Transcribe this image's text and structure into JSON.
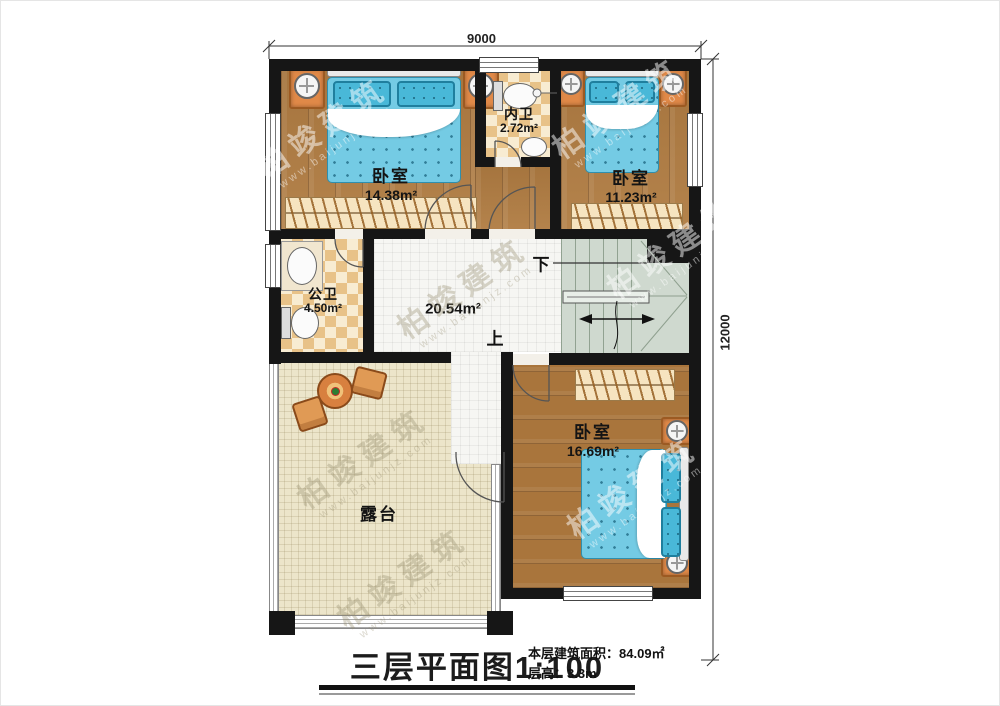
{
  "title": {
    "text": "三层平面图1:100"
  },
  "info": {
    "area_label": "本层建筑面积：",
    "area_value": "84.09㎡",
    "height_label": "层高：",
    "height_value": "3.3m"
  },
  "dimensions": {
    "top": "9000",
    "right": "12000"
  },
  "stairs": {
    "up": "上",
    "down": "下"
  },
  "rooms": [
    {
      "id": "bedroom-1",
      "name": "卧室",
      "area": "14.38m²"
    },
    {
      "id": "bath-inner",
      "name": "内卫",
      "area": "2.72m²"
    },
    {
      "id": "bedroom-2",
      "name": "卧室",
      "area": "11.23m²"
    },
    {
      "id": "bath-public",
      "name": "公卫",
      "area": "4.50m²"
    },
    {
      "id": "hall",
      "name": "",
      "area": "20.54m²"
    },
    {
      "id": "bedroom-3",
      "name": "卧室",
      "area": "16.69m²"
    },
    {
      "id": "terrace",
      "name": "露台",
      "area": ""
    }
  ],
  "watermark": {
    "brand": "柏竣建筑",
    "url": "www.baijunjz.com"
  },
  "colors": {
    "wall": "#161616",
    "wood": "#b07c42",
    "tile": "#f6f6f3",
    "checker_dark": "#e8c288",
    "checker_light": "#f8ecd2",
    "stairs": "#cfd9cf",
    "terrace": "#ece5ca",
    "bed_blue": "#74cbe4",
    "furniture_orange": "#e08948"
  }
}
